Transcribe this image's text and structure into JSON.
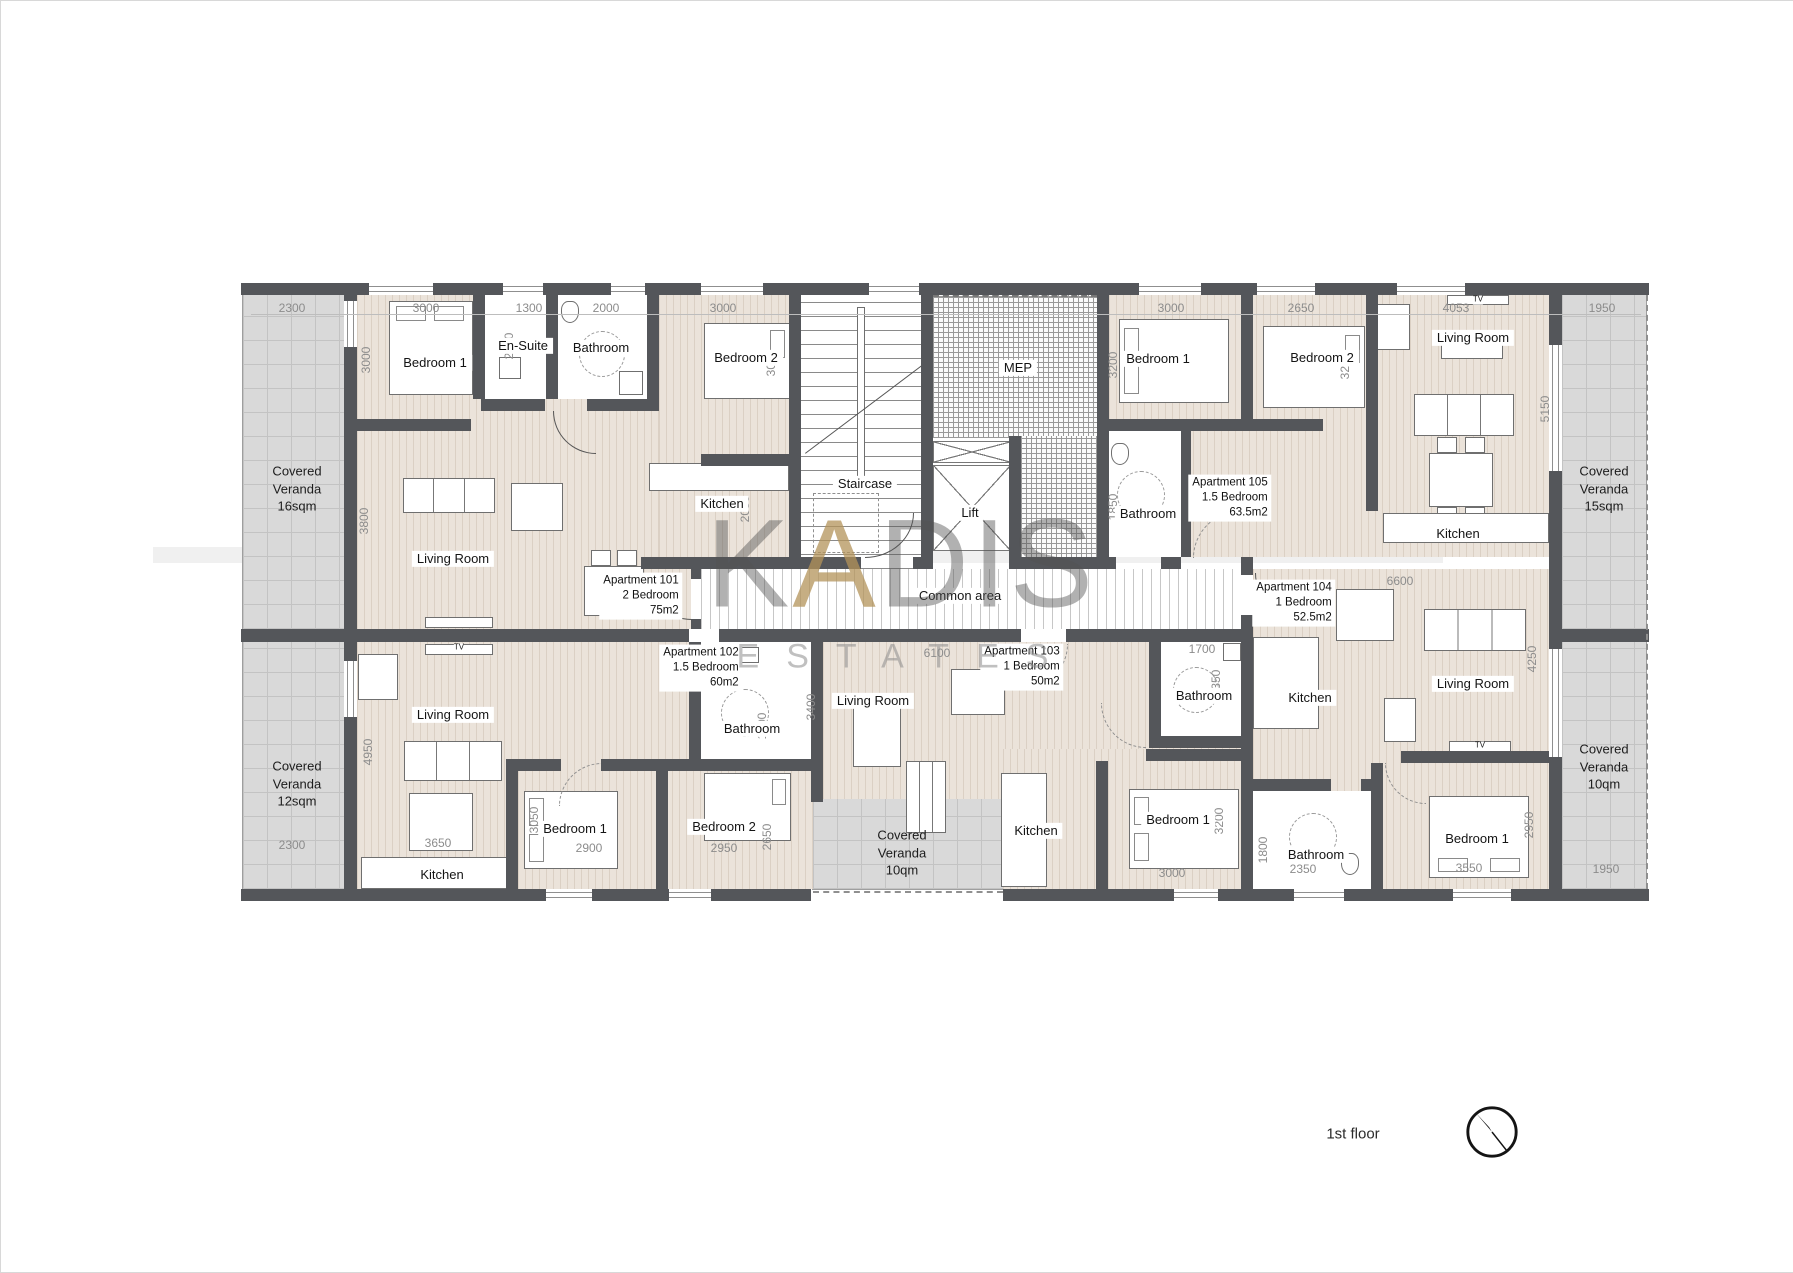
{
  "floor_title": "1st floor",
  "watermark": {
    "brand_k": "K",
    "brand_a": "A",
    "brand_dis": "DIS",
    "brand_sub": "ESTATES"
  },
  "core": {
    "staircase": "Staircase",
    "lift": "Lift",
    "mep": "MEP",
    "common_area": "Common area",
    "tv": "TV"
  },
  "apartments": {
    "a101": {
      "name": "Apartment 101",
      "type": "2 Bedroom",
      "area": "75m2"
    },
    "a102": {
      "name": "Apartment 102",
      "type": "1.5 Bedroom",
      "area": "60m2"
    },
    "a103": {
      "name": "Apartment 103",
      "type": "1 Bedroom",
      "area": "50m2"
    },
    "a104": {
      "name": "Apartment 104",
      "type": "1 Bedroom",
      "area": "52.5m2"
    },
    "a105": {
      "name": "Apartment 105",
      "type": "1.5 Bedroom",
      "area": "63.5m2"
    }
  },
  "rooms": {
    "a101_bed1": "Bedroom 1",
    "a101_ensuite": "En-Suite",
    "a101_bath": "Bathroom",
    "a101_bed2": "Bedroom 2",
    "a101_living": "Living Room",
    "a101_kitchen": "Kitchen",
    "a102_living": "Living Room",
    "a102_bath": "Bathroom",
    "a102_kitchen": "Kitchen",
    "a102_bed1": "Bedroom 1",
    "a102_bed2": "Bedroom 2",
    "a103_living": "Living Room",
    "a103_bath": "Bathroom",
    "a103_kitchen": "Kitchen",
    "a103_bed1": "Bedroom 1",
    "a104_kitchen": "Kitchen",
    "a104_living": "Living Room",
    "a104_bed1": "Bedroom 1",
    "a104_bath": "Bathroom",
    "a105_bed1": "Bedroom 1",
    "a105_bed2": "Bedroom 2",
    "a105_living": "Living Room",
    "a105_kitchen": "Kitchen",
    "a105_bath": "Bathroom"
  },
  "verandas": {
    "nw": {
      "l1": "Covered",
      "l2": "Veranda",
      "l3": "16sqm"
    },
    "sw": {
      "l1": "Covered",
      "l2": "Veranda",
      "l3": "12sqm"
    },
    "ne": {
      "l1": "Covered",
      "l2": "Veranda",
      "l3": "15sqm"
    },
    "se": {
      "l1": "Covered",
      "l2": "Veranda",
      "l3": "10qm"
    },
    "s": {
      "l1": "Covered",
      "l2": "Veranda",
      "l3": "10qm"
    }
  },
  "dims": {
    "v16_w": "2300",
    "v12_w": "2300",
    "v15_w": "1950",
    "v10_w": "1950",
    "a101_bed1_w": "3000",
    "a101_bed1_h": "3000",
    "a101_ensuite_w": "1300",
    "a101_ensuite_h": "2250",
    "a101_bath_w": "2000",
    "a101_bed2_w": "3000",
    "a101_bed2_h": "3000",
    "a101_living_h": "3800",
    "a101_kitchen_h": "2050",
    "a102_living_h": "4950",
    "a102_kitchen_w": "3650",
    "a102_bed1_w": "2900",
    "a102_bed1_h": "3050",
    "a102_bed2_w": "2950",
    "a102_bed2_h": "2650",
    "a102_bath_h": "1600",
    "a103_w": "6100",
    "a103_living_h": "3400",
    "a103_bed1_w": "3000",
    "a103_bed1_h": "3200",
    "a103_bath_w": "1700",
    "a103_bath_h": "2350",
    "a104_w": "6600",
    "a104_living_h": "4250",
    "a104_bed1_w": "3550",
    "a104_bed1_h": "2950",
    "a104_bath_w": "2350",
    "a104_bath_h": "1800",
    "a105_bed1_w": "3000",
    "a105_bed1_h": "3200",
    "a105_bed2_w": "2650",
    "a105_bed2_h": "3200",
    "a105_living_w": "4053",
    "a105_living_h": "5150",
    "a105_bath_h": "1850"
  },
  "colors": {
    "wall": "#54565a",
    "floor": "#ebe3da",
    "veranda": "#d9d9d9",
    "accent_gold": "#b3935a"
  }
}
